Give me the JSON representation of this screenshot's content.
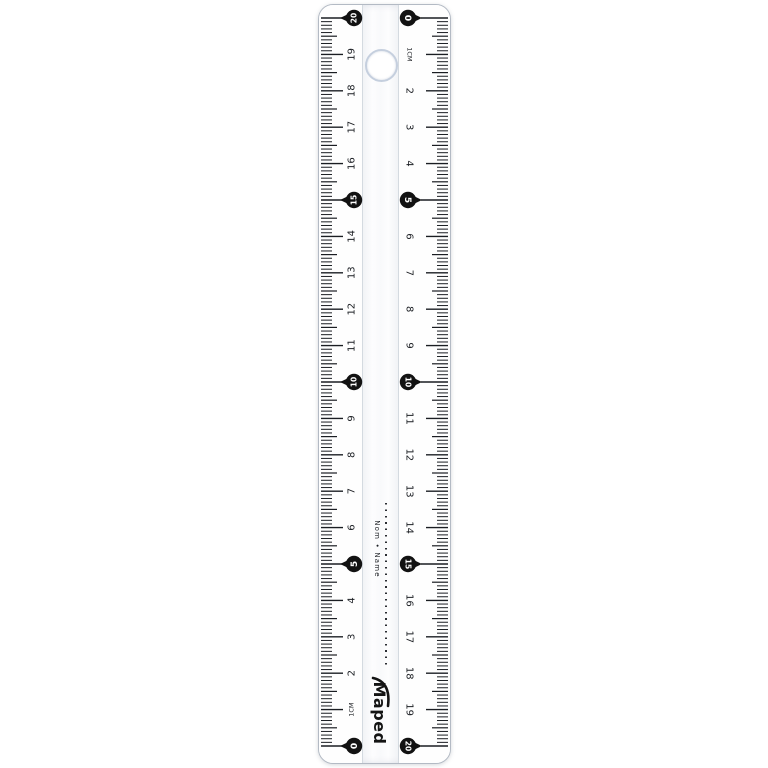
{
  "product": {
    "brand": "Maped",
    "name_line_label": "Nom • Name"
  },
  "ruler": {
    "length_cm": 20,
    "unit_label": "1CM",
    "circled_values": [
      0,
      5,
      10,
      15,
      20
    ],
    "left_scale": {
      "zero_position": "bottom",
      "labels_by_value": [
        "0",
        "1CM",
        "2",
        "3",
        "4",
        "5",
        "6",
        "7",
        "8",
        "9",
        "10",
        "11",
        "12",
        "13",
        "14",
        "15",
        "16",
        "17",
        "18",
        "19",
        "20"
      ]
    },
    "right_scale": {
      "zero_position": "top",
      "labels_by_value": [
        "0",
        "1CM",
        "2",
        "3",
        "4",
        "5",
        "6",
        "7",
        "8",
        "9",
        "10",
        "11",
        "12",
        "13",
        "14",
        "15",
        "16",
        "17",
        "18",
        "19",
        "20"
      ]
    },
    "colors": {
      "tick": "#1a1d22",
      "marker_fill": "#121212",
      "marker_text": "#ffffff",
      "body": "#fdfdfe",
      "edge": "#b3bac4",
      "divider": "#d4dae0",
      "hole_ring": "#c5cfde",
      "background": "#ffffff"
    }
  }
}
